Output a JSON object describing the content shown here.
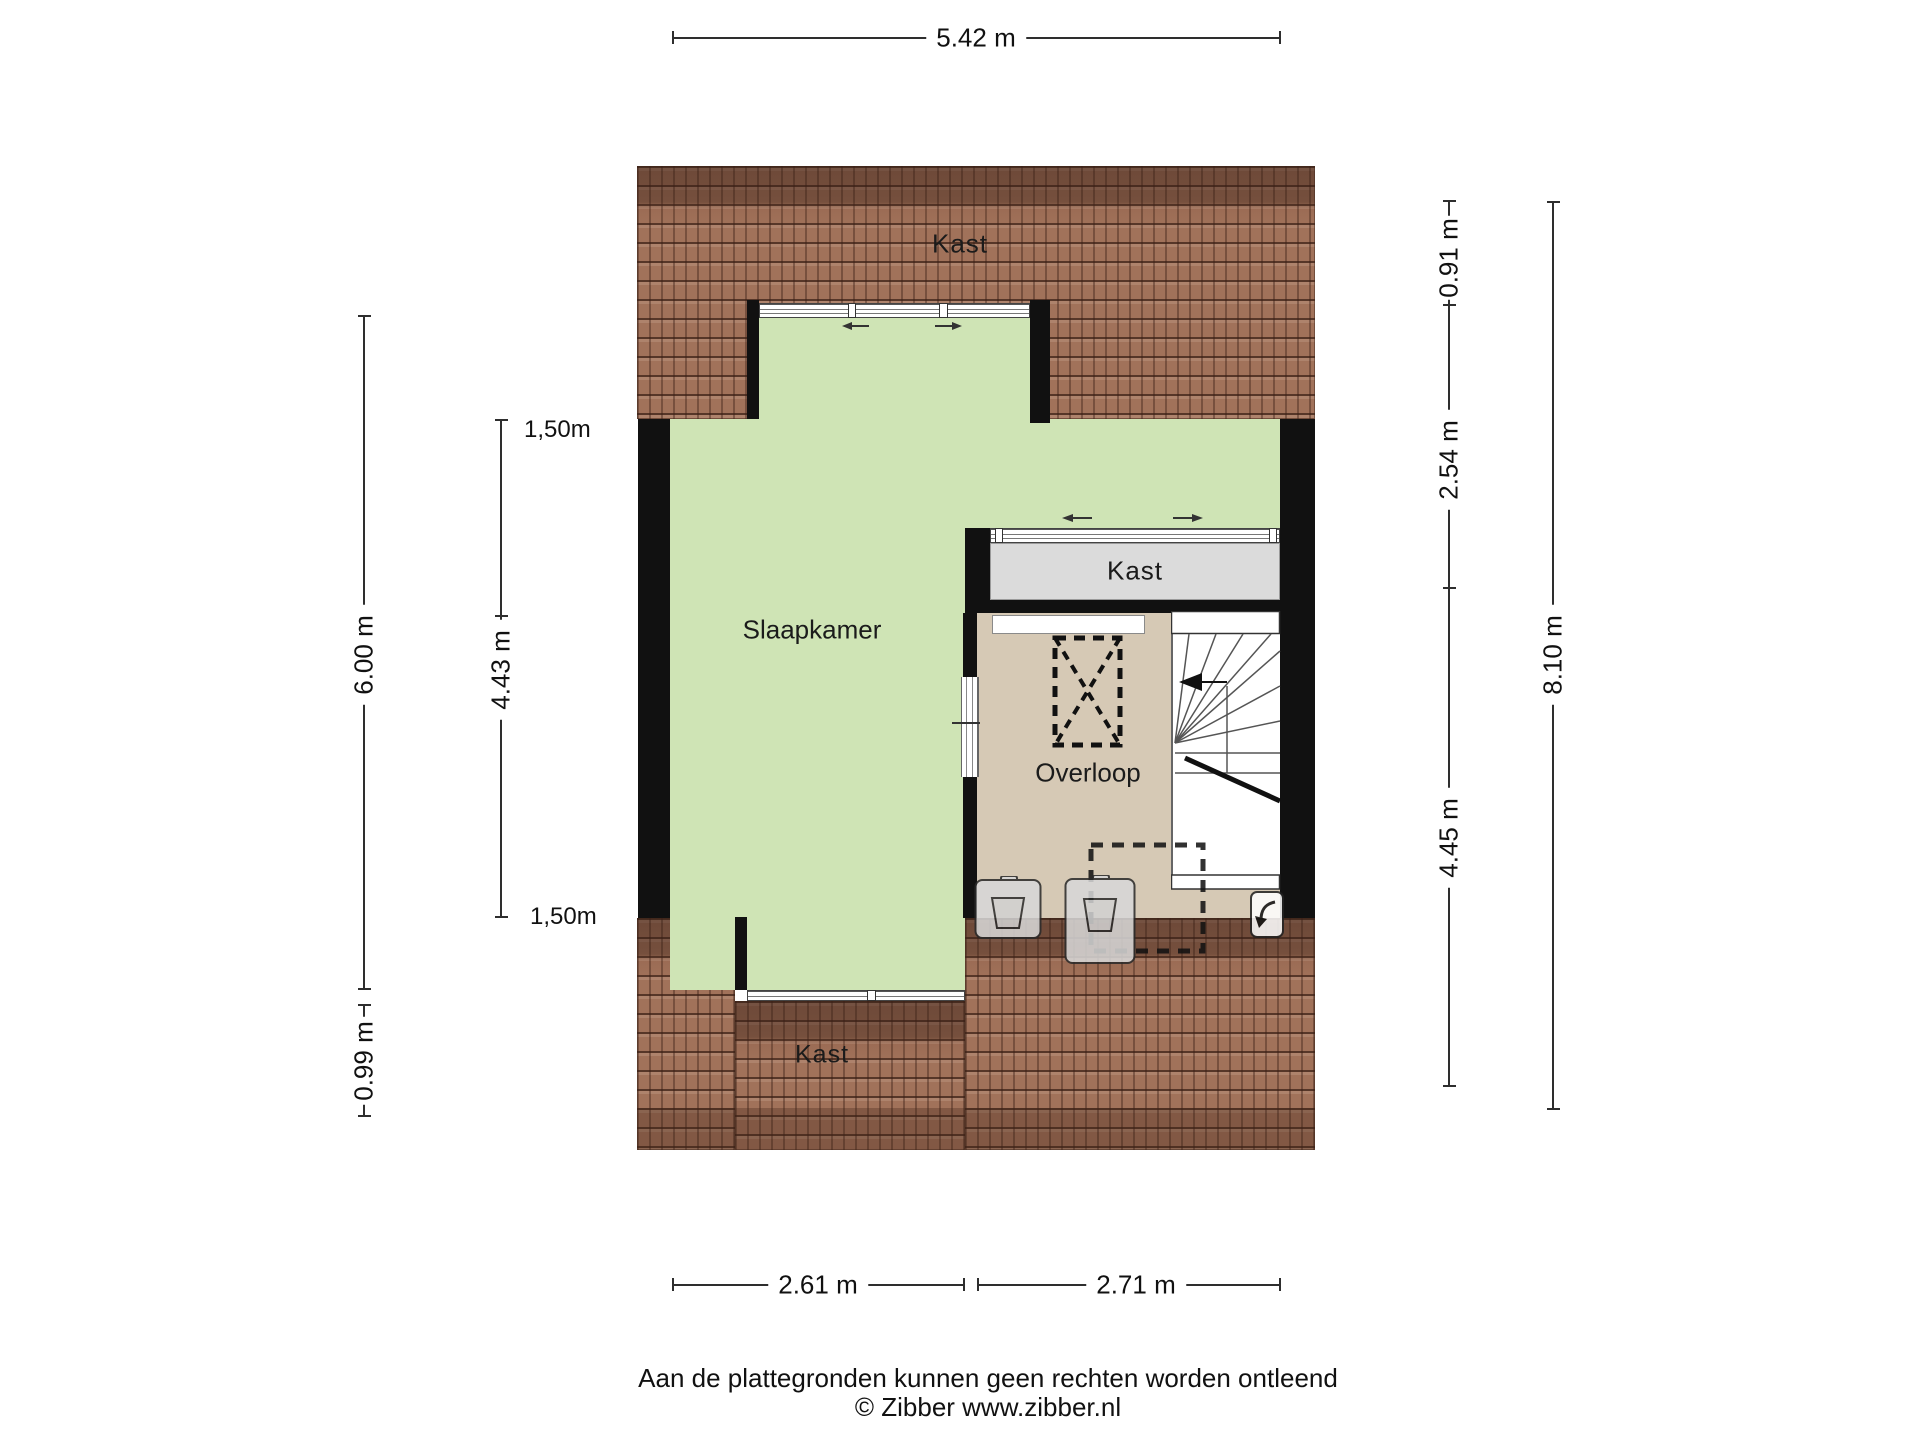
{
  "rooms": {
    "closet_top": {
      "label": "Kast"
    },
    "bedroom": {
      "label": "Slaapkamer"
    },
    "closet_middle": {
      "label": "Kast"
    },
    "landing": {
      "label": "Overloop"
    },
    "closet_bottom": {
      "label": "Kast"
    }
  },
  "dimensions": {
    "top_width": "5.42 m",
    "bottom_left_width": "2.61 m",
    "bottom_right_width": "2.71 m",
    "left_outer_height": "6.00 m",
    "left_outer_small": "0.99 m",
    "left_inner_knee_top": "1,50m",
    "left_inner_height": "4.43 m",
    "left_inner_knee_bottom": "1,50m",
    "right_inner_top": "0.91 m",
    "right_inner_middle": "2.54 m",
    "right_inner_bottom": "4.45 m",
    "right_outer_height": "8.10 m"
  },
  "footer": {
    "disclaimer": "Aan de plattegronden kunnen geen rechten worden ontleend",
    "copyright": "© Zibber www.zibber.nl"
  },
  "colors": {
    "bedroom_floor": "#cfe4b5",
    "landing_floor": "#d6c9b5",
    "closet_floor": "#dbdbdb",
    "roof_tiles": "#a1725a",
    "walls": "#111111",
    "dimension_lines": "#2e2e2e"
  }
}
